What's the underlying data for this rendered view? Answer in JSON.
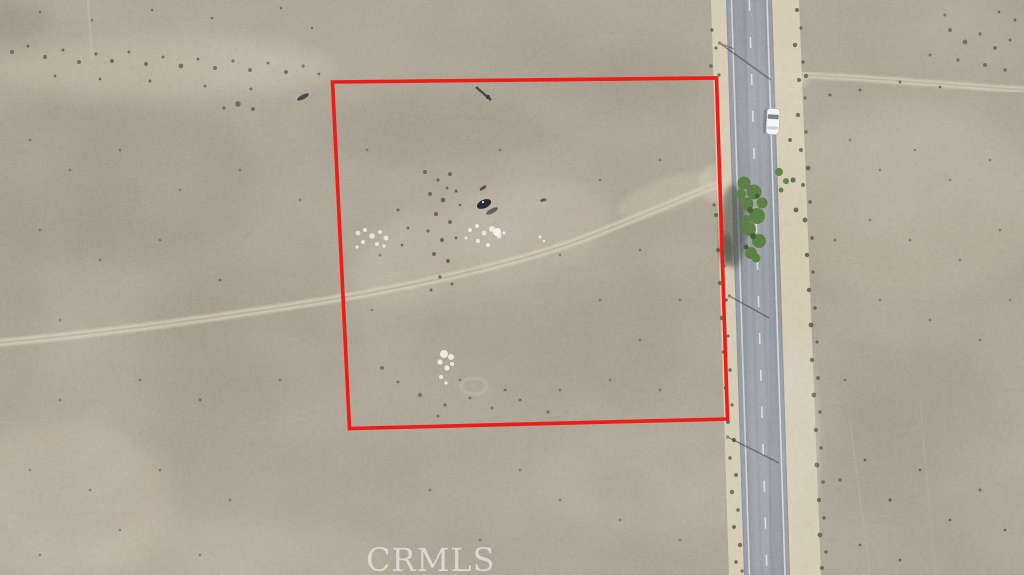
{
  "scene": {
    "type": "aerial-drone-photo",
    "description": "Top-down drone photo of a vacant desert scrubland parcel outlined with a red boundary, beside a paved two-lane road running along the right side with a white vehicle, roadside shrubs, a tree, dirt trails and scattered debris.",
    "watermark": "CRMLS"
  },
  "colors": {
    "terrain_base": "#a79e8e",
    "terrain_light": "#cfc5ae",
    "terrain_dark": "#857d6e",
    "shoulder": "#d6cbb2",
    "road_asphalt": "#8d949b",
    "road_worn": "#b3b7ba",
    "road_marking": "#f2f2ee",
    "shrub_dark": "#49513b",
    "tree_green": "#4e7434",
    "shadow_dark": "#2e352b",
    "trail_light": "#d0c6af",
    "boundary_red": "#ee1b17",
    "vehicle_white": "#f7f8f6",
    "vehicle_glass": "#6b7177",
    "debris_white": "#f1ede1",
    "watermark_white": "rgba(255,255,255,0.55)"
  }
}
